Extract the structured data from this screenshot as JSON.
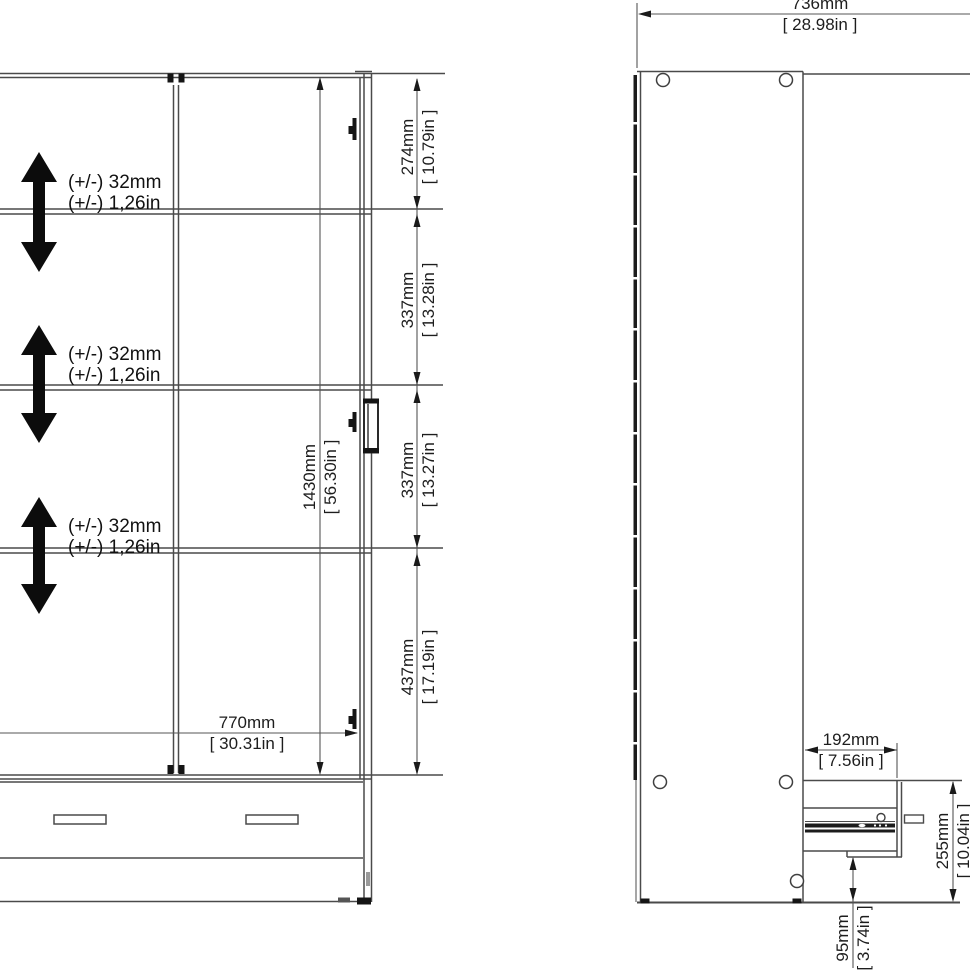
{
  "drawing_title": "wardrobe-dimension-drawing",
  "front_view": {
    "shelf_adjust_notes": [
      {
        "line1": "(+/-) 32mm",
        "line2": "(+/-) 1,26in"
      },
      {
        "line1": "(+/-) 32mm",
        "line2": "(+/-) 1,26in"
      },
      {
        "line1": "(+/-) 32mm",
        "line2": "(+/-) 1,26in"
      }
    ],
    "dim_interior_height": {
      "mm": "1430mm",
      "in": "[ 56.30in ]"
    },
    "dim_top_section": {
      "mm": "274mm",
      "in": "[ 10.79in ]"
    },
    "dim_second_section": {
      "mm": "337mm",
      "in": "[ 13.28in ]"
    },
    "dim_third_section": {
      "mm": "337mm",
      "in": "[ 13.27in ]"
    },
    "dim_bottom_section": {
      "mm": "437mm",
      "in": "[ 17.19in ]"
    },
    "dim_width": {
      "mm": "770mm",
      "in": "[ 30.31in ]"
    }
  },
  "side_view": {
    "dim_depth": {
      "mm": "736mm",
      "in": "[ 28.98in ]"
    },
    "dim_drawer_depth": {
      "mm": "192mm",
      "in": "[ 7.56in ]"
    },
    "dim_drawer_height": {
      "mm": "255mm",
      "in": "[ 10.04in ]"
    },
    "dim_plinth_height": {
      "mm": "95mm",
      "in": "[ 3.74in ]"
    }
  },
  "colors": {
    "line": "#4a4a4a",
    "dim_line": "#555555",
    "dark": "#151515",
    "background": "#ffffff",
    "text": "#1d1d1d"
  }
}
